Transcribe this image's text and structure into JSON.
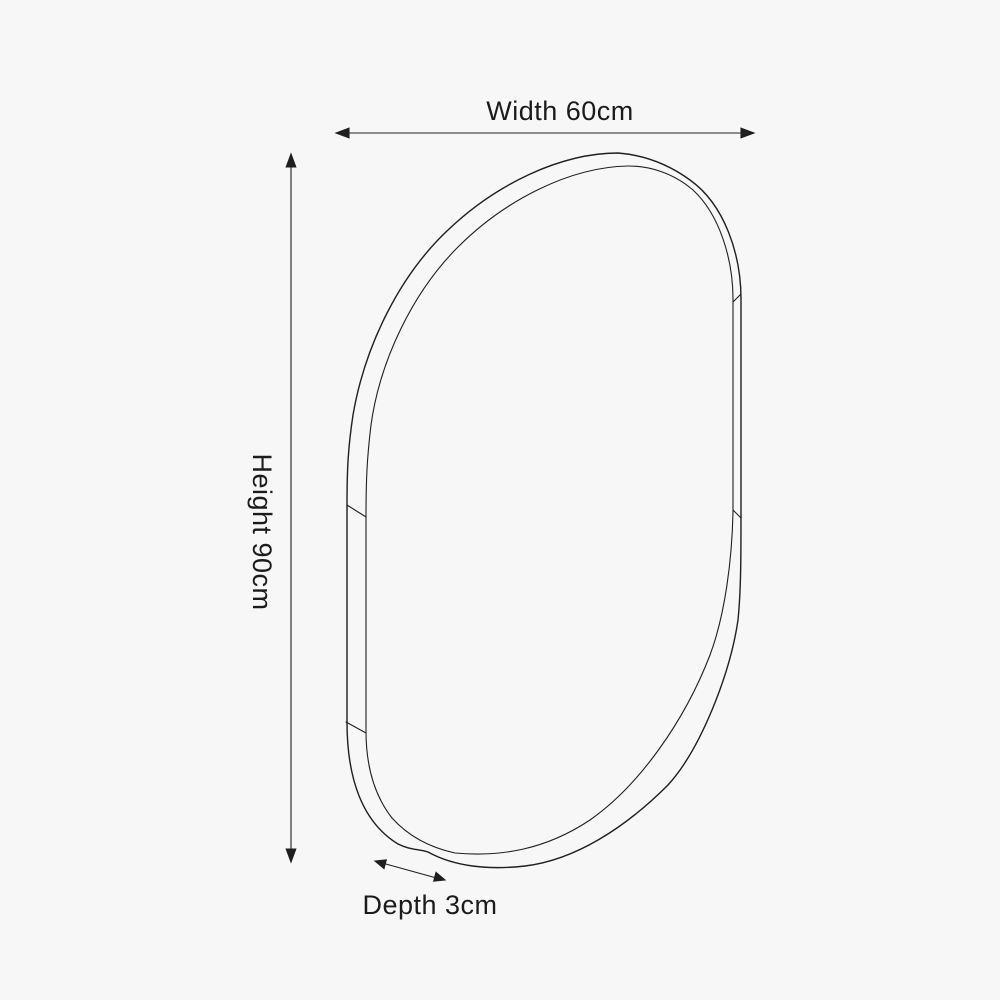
{
  "page": {
    "background_color": "#f7f7f7"
  },
  "diagram": {
    "figure": "oval-mirror-outline-drawing",
    "line_color": "#1f1f1f",
    "text_color": "#1b1b1b",
    "dimensions": {
      "width": {
        "label": "Width 60cm",
        "value": 60,
        "unit": "cm"
      },
      "height": {
        "label": "Height 90cm",
        "value": 90,
        "unit": "cm"
      },
      "depth": {
        "label": "Depth 3cm",
        "value": 3,
        "unit": "cm"
      }
    }
  }
}
